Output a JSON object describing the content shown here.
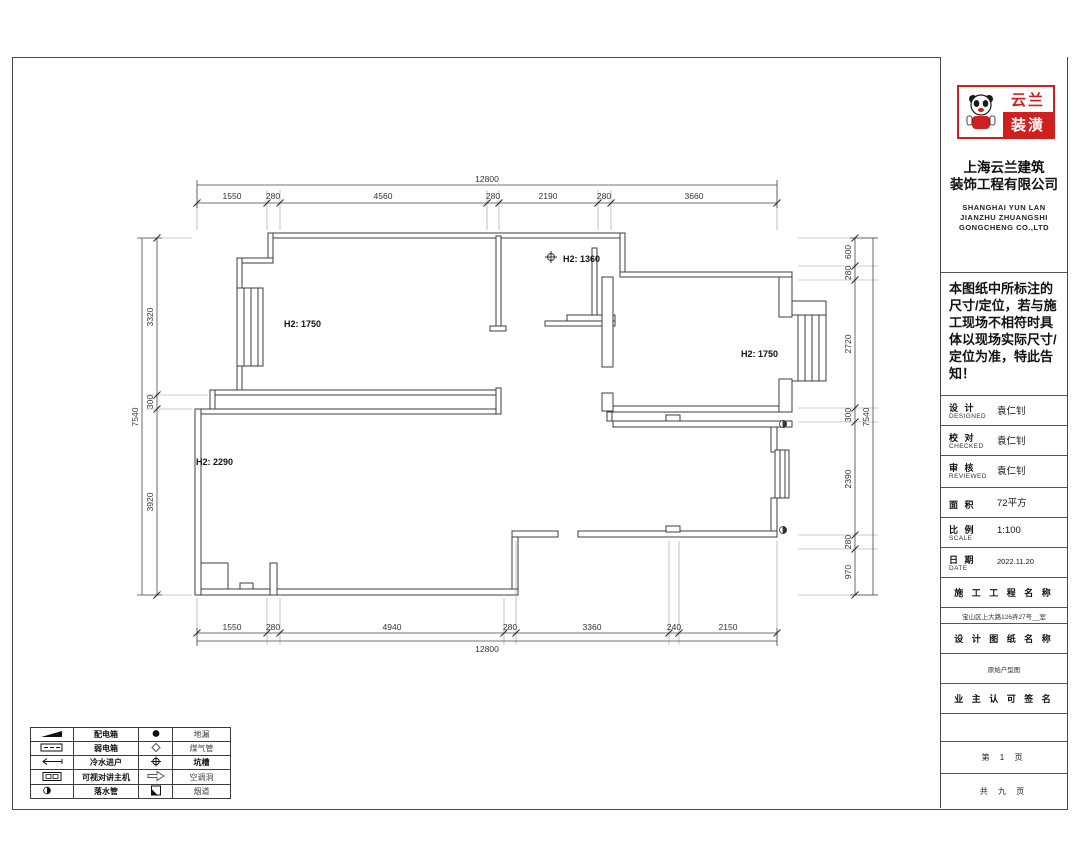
{
  "sheet": {
    "logo": {
      "brand_top": "云兰",
      "brand_bottom": "装潢",
      "accent": "#cf1f1f"
    },
    "company_cn_1": "上海云兰建筑",
    "company_cn_2": "装饰工程有限公司",
    "company_en_1": "SHANGHAI YUN LAN",
    "company_en_2": "JIANZHU ZHUANGSHI",
    "company_en_3": "GONGCHENG CO.,LTD",
    "notice": "本图纸中所标注的尺寸/定位，若与施工现场不相符时具体以现场实际尺寸/定位为准，特此告知！",
    "fields": [
      {
        "cn": "设 计",
        "en": "DESIGNED",
        "value": "袁仁钊"
      },
      {
        "cn": "校 对",
        "en": "CHECKED",
        "value": "袁仁钊"
      },
      {
        "cn": "审 核",
        "en": "REVIEWED",
        "value": "袁仁钊"
      },
      {
        "cn": "面 积",
        "en": "",
        "value": "72平方"
      },
      {
        "cn": "比 例",
        "en": "SCALE",
        "value": "1:100"
      },
      {
        "cn": "日 期",
        "en": "DATE",
        "value": "2022.11.20"
      }
    ],
    "section_project_title": "施 工 工 程 名 称",
    "project_address": "宝山区上大路126弄27号__室",
    "section_drawing_title": "设 计 图 纸 名 称",
    "drawing_name": "原始户型图",
    "section_sign_title": "业 主 认 可 签 名",
    "page_current": "第 1 页",
    "page_total": "共 九 页"
  },
  "plan": {
    "room_labels": [
      {
        "text": "H2: 1750"
      },
      {
        "text": "H2: 1360"
      },
      {
        "text": "H2: 1750"
      },
      {
        "text": "H2: 2290"
      }
    ],
    "dims": {
      "top_total": "12800",
      "top": [
        "1550",
        "280",
        "4560",
        "280",
        "2190",
        "280",
        "3660"
      ],
      "bottom": [
        "1550",
        "280",
        "4940",
        "280",
        "3360",
        "240",
        "2150"
      ],
      "bottom_total": "12800",
      "left": [
        "3320",
        "300",
        "3920"
      ],
      "left_total": "7540",
      "right": [
        "600",
        "280",
        "2720",
        "300",
        "2390",
        "280",
        "970"
      ],
      "right_total": "7540"
    }
  },
  "legend": {
    "rows": [
      {
        "label1": "配电箱",
        "label2": "地漏"
      },
      {
        "label1": "弱电箱",
        "label2": "煤气管"
      },
      {
        "label1": "冷水进户",
        "label2": "坑槽"
      },
      {
        "label1": "可视对讲主机",
        "label2": "空调洞"
      },
      {
        "label1": "落水管",
        "label2": "烟道"
      }
    ]
  }
}
